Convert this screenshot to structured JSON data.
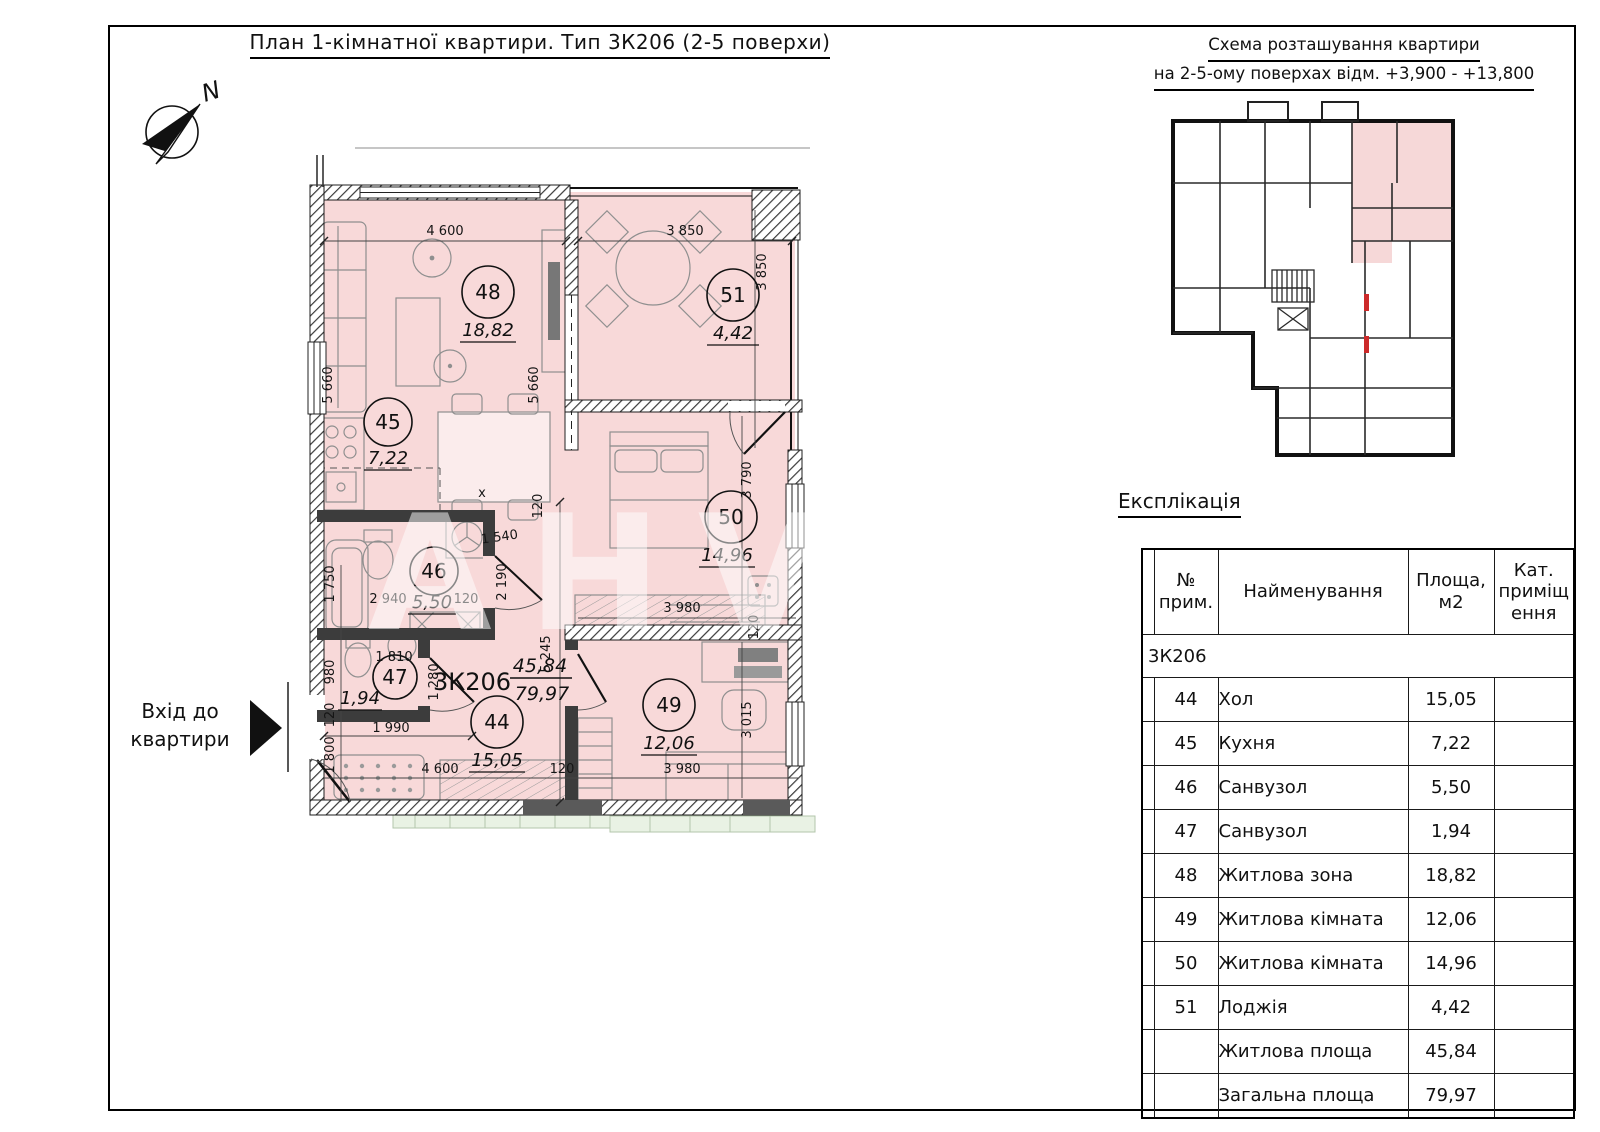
{
  "sheet": {
    "plan_title": "План 1-кімнатної квартири. Тип 3К206 (2-5 поверхи)",
    "schema_title_line1": "Схема розташування квартири",
    "schema_title_line2": "на 2-5-ому поверхах відм. +3,900 - +13,800",
    "watermark": "АНVA"
  },
  "plan": {
    "north_label": "N",
    "entrance_label_line1": "Вхід до",
    "entrance_label_line2": "квартири",
    "apartment": {
      "code": "3К206",
      "living_area": "45,84",
      "total_area": "79,97"
    },
    "rooms": [
      {
        "number": "44",
        "area": "15,05"
      },
      {
        "number": "45",
        "area": "7,22"
      },
      {
        "number": "46",
        "area": "5,50"
      },
      {
        "number": "47",
        "area": "1,94"
      },
      {
        "number": "48",
        "area": "18,82"
      },
      {
        "number": "49",
        "area": "12,06"
      },
      {
        "number": "50",
        "area": "14,96"
      },
      {
        "number": "51",
        "area": "4,42"
      }
    ],
    "dimensions": {
      "d4600": "4 600",
      "d5660": "5 660",
      "d3850": "3 850",
      "d3790": "3 790",
      "d3980": "3 980",
      "d3015": "3 015",
      "d120": "120",
      "d1540": "1 540",
      "d2190": "2 190",
      "d5245": "5 245",
      "d2940": "2 940",
      "d1750": "1 750",
      "d1810": "1 810",
      "d980": "980",
      "d1280": "1 280",
      "d1990": "1 990",
      "d1800": "1 800",
      "mark_x": "x"
    },
    "colors": {
      "room_fill": "#f8d9d9",
      "wall": "#3c3c3c",
      "green_strip": "#e9f2e4"
    }
  },
  "schema": {
    "highlight_color": "#f6d8d8",
    "marker_color": "#cc2a2a"
  },
  "explication": {
    "heading": "Експлікація",
    "columns": {
      "no": "№\nприм.",
      "name": "Найменування",
      "area": "Площа,\nм2",
      "category": "Кат.\nприміщ\nення"
    },
    "group_code": "3К206",
    "rows": [
      {
        "no": "44",
        "name": "Хол",
        "area": "15,05",
        "category": ""
      },
      {
        "no": "45",
        "name": "Кухня",
        "area": "7,22",
        "category": ""
      },
      {
        "no": "46",
        "name": "Санвузол",
        "area": "5,50",
        "category": ""
      },
      {
        "no": "47",
        "name": "Санвузол",
        "area": "1,94",
        "category": ""
      },
      {
        "no": "48",
        "name": "Житлова зона",
        "area": "18,82",
        "category": ""
      },
      {
        "no": "49",
        "name": "Житлова кімната",
        "area": "12,06",
        "category": ""
      },
      {
        "no": "50",
        "name": "Житлова кімната",
        "area": "14,96",
        "category": ""
      },
      {
        "no": "51",
        "name": "Лоджія",
        "area": "4,42",
        "category": ""
      }
    ],
    "totals": [
      {
        "name": "Житлова площа",
        "area": "45,84"
      },
      {
        "name": "Загальна площа",
        "area": "79,97"
      }
    ]
  }
}
